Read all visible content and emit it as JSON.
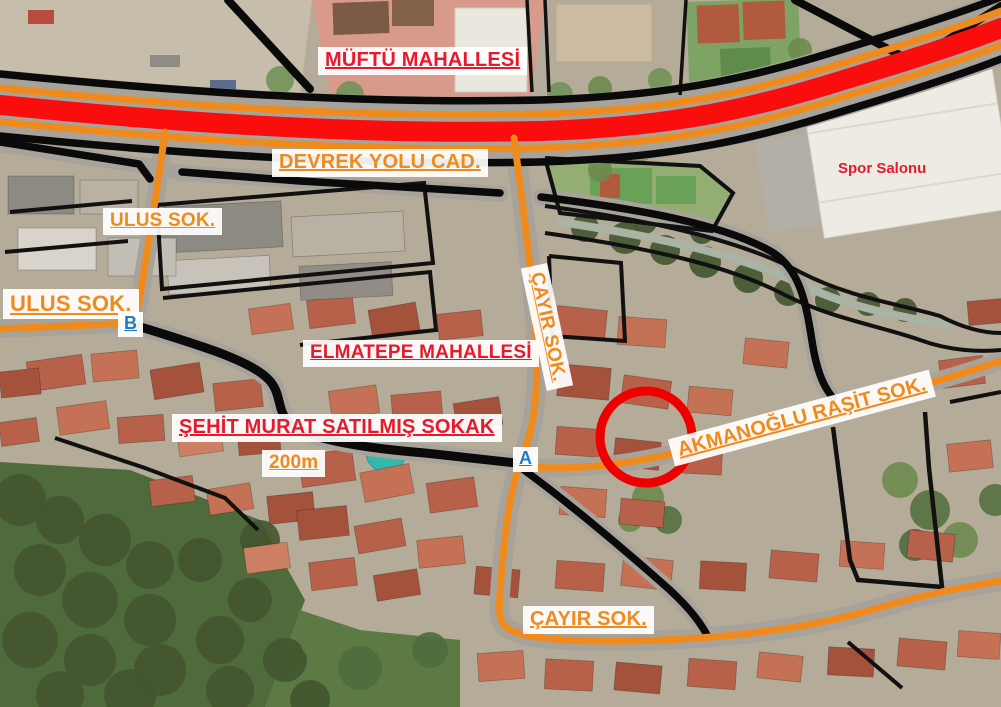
{
  "labels": {
    "muftu_mahallesi": "MÜFTÜ MAHALLESİ",
    "devrek_yolu": "DEVREK YOLU CAD.",
    "ulus_sok_upper": "ULUS SOK.",
    "ulus_sok_lower": "ULUS SOK.",
    "elmatepe_mahallesi": "ELMATEPE MAHALLESİ",
    "sehit_murat": "ŞEHİT MURAT SATILMIŞ SOKAK",
    "scale_200m": "200m",
    "cayir_sok_vertical": "ÇAYIR SOK.",
    "akmanoglu_rasit": "AKMANOĞLU RAŞİT SOK.",
    "cayir_sok_bottom": "ÇAYIR SOK.",
    "spor_salonu": "Spor Salonu"
  },
  "markers": {
    "a": "A",
    "b": "B"
  },
  "colors": {
    "street_label_orange": "#ef8a1d",
    "district_label_red": "#e8192c",
    "marker_blue": "#1a7fc4",
    "highway_red": "#f90d0d",
    "road_orange": "#ef8a1d",
    "road_black": "#0a0a0a",
    "highlight_circle_red": "#ee0000"
  }
}
